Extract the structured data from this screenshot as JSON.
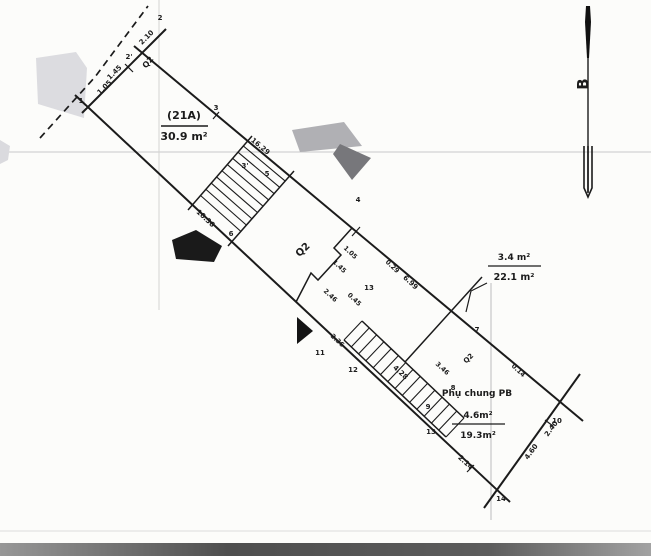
{
  "colors": {
    "ink": "#1b1b1b",
    "grid": "#c9c9c9",
    "grid_faint": "#dcdcdc",
    "shade_light": "#dadade",
    "shade_mid": "#a9a9ad",
    "shade_dark": "#6e6e72",
    "scan_band": "#565656"
  },
  "north_arrow": {
    "label": "B"
  },
  "parcel": {
    "lot_code": "(21A)",
    "lot_area": "30.9 m²",
    "zone_label": "Q2",
    "annex": {
      "area": "3.4 m²",
      "total": "22.1 m²"
    },
    "shared": {
      "title": "Phụ chung PB",
      "area": "4.6m²",
      "total": "19.3m²"
    }
  },
  "point_numbers": [
    "1",
    "2",
    "2'",
    "3",
    "3'",
    "4",
    "5",
    "6",
    "7",
    "8",
    "9",
    "10",
    "11",
    "12",
    "13",
    "14"
  ],
  "dimensions": [
    "2.10",
    "1.45",
    "1.05",
    "16.29",
    "10.36",
    "0.29",
    "6.99",
    "2.46",
    "0.45",
    "2.36",
    "4.28",
    "3.46",
    "0.14",
    "2.14",
    "4.60",
    "2.40"
  ],
  "labels": [
    {
      "name": "lot-code",
      "text": "(21A)",
      "x": 184,
      "y": 119,
      "rot": 0,
      "size": 11,
      "bold": true
    },
    {
      "name": "lot-area",
      "text": "30.9 m²",
      "x": 184,
      "y": 140,
      "rot": 0,
      "size": 11,
      "bold": true
    },
    {
      "name": "annex-area",
      "text": "3.4 m²",
      "x": 514,
      "y": 260,
      "rot": 0,
      "size": 9,
      "bold": true
    },
    {
      "name": "annex-total",
      "text": "22.1 m²",
      "x": 514,
      "y": 280,
      "rot": 0,
      "size": 9.5,
      "bold": true
    },
    {
      "name": "shared-title",
      "text": "Phụ chung PB",
      "x": 477,
      "y": 396,
      "rot": 0,
      "size": 9,
      "bold": true
    },
    {
      "name": "shared-area",
      "text": "4.6m²",
      "x": 478,
      "y": 418,
      "rot": 0,
      "size": 9,
      "bold": true
    },
    {
      "name": "shared-total",
      "text": "19.3m²",
      "x": 478,
      "y": 438,
      "rot": 0,
      "size": 9,
      "bold": true
    },
    {
      "name": "north-letter",
      "text": "B",
      "x": 588,
      "y": 84,
      "rot": -90,
      "size": 15,
      "bold": true
    },
    {
      "name": "zone-q2-main",
      "text": "Q2",
      "x": 305,
      "y": 252,
      "rot": -44,
      "size": 10,
      "bold": true
    },
    {
      "name": "zone-q2-top",
      "text": "Q2",
      "x": 150,
      "y": 64,
      "rot": -50,
      "size": 8,
      "bold": true
    },
    {
      "name": "zone-q2-right",
      "text": "Q2",
      "x": 470,
      "y": 360,
      "rot": -44,
      "size": 7,
      "bold": true
    },
    {
      "name": "pt-1",
      "text": "1",
      "x": 81,
      "y": 103,
      "rot": 0,
      "size": 7,
      "bold": true
    },
    {
      "name": "pt-2",
      "text": "2",
      "x": 160,
      "y": 20,
      "rot": 0,
      "size": 7,
      "bold": true
    },
    {
      "name": "pt-2p",
      "text": "2'",
      "x": 129,
      "y": 59,
      "rot": 0,
      "size": 7,
      "bold": true
    },
    {
      "name": "pt-3",
      "text": "3",
      "x": 216,
      "y": 110,
      "rot": 0,
      "size": 7,
      "bold": true
    },
    {
      "name": "pt-3p",
      "text": "3'",
      "x": 245,
      "y": 168,
      "rot": 0,
      "size": 7,
      "bold": true
    },
    {
      "name": "pt-5",
      "text": "5",
      "x": 267,
      "y": 176,
      "rot": 0,
      "size": 7,
      "bold": true
    },
    {
      "name": "pt-6",
      "text": "6",
      "x": 231,
      "y": 236,
      "rot": 0,
      "size": 7,
      "bold": true
    },
    {
      "name": "pt-4",
      "text": "4",
      "x": 358,
      "y": 202,
      "rot": 0,
      "size": 7,
      "bold": true
    },
    {
      "name": "pt-13a",
      "text": "13",
      "x": 369,
      "y": 290,
      "rot": 0,
      "size": 7,
      "bold": true
    },
    {
      "name": "pt-7",
      "text": "7",
      "x": 477,
      "y": 332,
      "rot": 0,
      "size": 7,
      "bold": true
    },
    {
      "name": "pt-10",
      "text": "10",
      "x": 557,
      "y": 423,
      "rot": 0,
      "size": 7,
      "bold": true
    },
    {
      "name": "pt-14",
      "text": "14",
      "x": 501,
      "y": 501,
      "rot": 0,
      "size": 7,
      "bold": true
    },
    {
      "name": "pt-11",
      "text": "11",
      "x": 320,
      "y": 355,
      "rot": 0,
      "size": 7,
      "bold": true
    },
    {
      "name": "pt-12",
      "text": "12",
      "x": 353,
      "y": 372,
      "rot": 0,
      "size": 7,
      "bold": true
    },
    {
      "name": "pt-13b",
      "text": "13",
      "x": 431,
      "y": 434,
      "rot": 0,
      "size": 7,
      "bold": true
    },
    {
      "name": "pt-8",
      "text": "8",
      "x": 453,
      "y": 390,
      "rot": 0,
      "size": 7,
      "bold": true
    },
    {
      "name": "pt-9",
      "text": "9",
      "x": 428,
      "y": 409,
      "rot": 0,
      "size": 7,
      "bold": true
    },
    {
      "name": "dim-210",
      "text": "2.10",
      "x": 148,
      "y": 39,
      "rot": -45,
      "size": 7,
      "bold": true
    },
    {
      "name": "dim-145a",
      "text": "1.45",
      "x": 116,
      "y": 74,
      "rot": -45,
      "size": 7,
      "bold": true
    },
    {
      "name": "dim-105a",
      "text": "1.05",
      "x": 106,
      "y": 89,
      "rot": -45,
      "size": 7,
      "bold": true
    },
    {
      "name": "dim-1629",
      "text": "16.29",
      "x": 259,
      "y": 148,
      "rot": 40,
      "size": 7,
      "bold": true
    },
    {
      "name": "dim-1036",
      "text": "10.36",
      "x": 204,
      "y": 220,
      "rot": 43,
      "size": 7,
      "bold": true
    },
    {
      "name": "dim-105b",
      "text": "1.05",
      "x": 349,
      "y": 254,
      "rot": 43,
      "size": 6.5,
      "bold": true
    },
    {
      "name": "dim-145b",
      "text": "1.45",
      "x": 338,
      "y": 268,
      "rot": 43,
      "size": 6.5,
      "bold": true
    },
    {
      "name": "dim-029",
      "text": "0.29",
      "x": 391,
      "y": 268,
      "rot": 43,
      "size": 6.5,
      "bold": true
    },
    {
      "name": "dim-699",
      "text": "6.99",
      "x": 409,
      "y": 284,
      "rot": 43,
      "size": 7,
      "bold": true
    },
    {
      "name": "dim-246",
      "text": "2.46",
      "x": 329,
      "y": 297,
      "rot": 43,
      "size": 6.5,
      "bold": true
    },
    {
      "name": "dim-045",
      "text": "0.45",
      "x": 353,
      "y": 301,
      "rot": 43,
      "size": 6.5,
      "bold": true
    },
    {
      "name": "dim-236",
      "text": "2.36",
      "x": 336,
      "y": 342,
      "rot": 43,
      "size": 6.5,
      "bold": true
    },
    {
      "name": "dim-428",
      "text": "4.28",
      "x": 399,
      "y": 374,
      "rot": 43,
      "size": 7,
      "bold": true
    },
    {
      "name": "dim-346",
      "text": "3.46",
      "x": 441,
      "y": 370,
      "rot": 43,
      "size": 6.5,
      "bold": true
    },
    {
      "name": "dim-014",
      "text": "0.14",
      "x": 517,
      "y": 372,
      "rot": 43,
      "size": 6.5,
      "bold": true
    },
    {
      "name": "dim-214",
      "text": "2.14",
      "x": 464,
      "y": 464,
      "rot": 43,
      "size": 7,
      "bold": true
    },
    {
      "name": "dim-460",
      "text": "4.60",
      "x": 533,
      "y": 453,
      "rot": -54,
      "size": 7,
      "bold": true
    },
    {
      "name": "dim-240",
      "text": "2.40",
      "x": 553,
      "y": 430,
      "rot": -54,
      "size": 7,
      "bold": true
    }
  ]
}
